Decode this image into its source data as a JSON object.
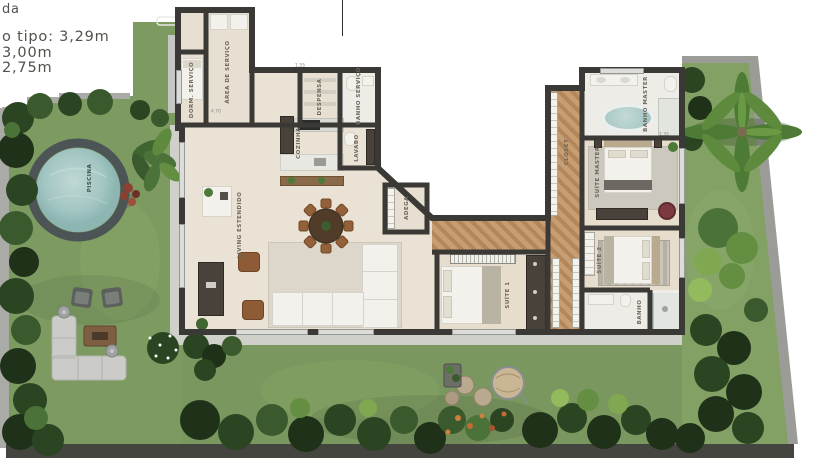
{
  "legend": {
    "lines": [
      "da",
      "o tipo: 3,29m",
      "3,00m",
      "2,75m"
    ]
  },
  "rooms": {
    "dorm_servico": "DORM. SERVIÇO",
    "area_servico": "ÁREA DE SERVIÇO",
    "despensa": "DESPENSA",
    "banho_servico": "BANHO SERVIÇO",
    "cozinha": "COZINHA",
    "lavabo": "LAVABO",
    "adega": "ADEGA",
    "living": "LIVING ESTENDIDO",
    "suite1": "SUÍTE 1",
    "closet": "CLOSET",
    "banho_master": "BANHO MASTER",
    "suite_master": "SUÍTE MASTER",
    "suite2": "SUÍTE 2",
    "banho_suite2": "BANHO",
    "piscina": "PISCINA"
  },
  "dimensions": {
    "d1": "4.70",
    "d2": "1.55",
    "d3": "1.35"
  },
  "colors": {
    "grass": "#7e9b62",
    "foliage_dark": "#2b4523",
    "wall": "#3a3936",
    "floor": "#eae2d4",
    "wood": "#c1976b",
    "pool_water": "#a7c9c6",
    "pool_deck": "#4d5456",
    "terrace": "#cfd0ca",
    "accent_chair": "#7c3a40"
  }
}
